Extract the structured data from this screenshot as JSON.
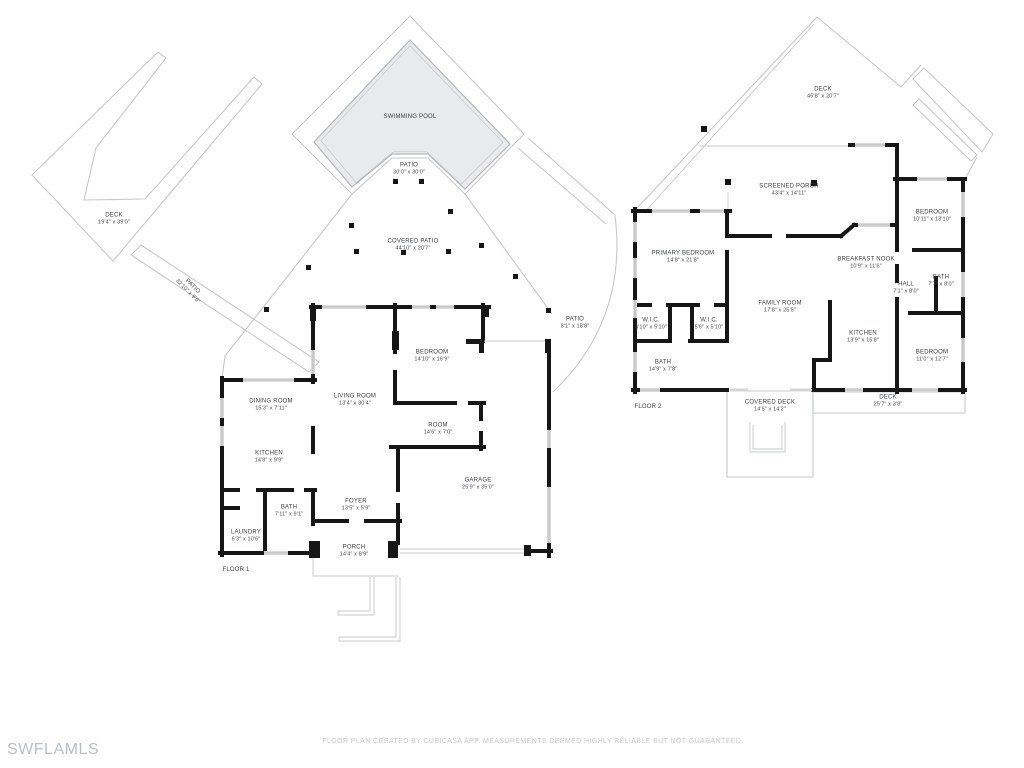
{
  "watermark": "SWFLAMLS",
  "footer": "FLOOR PLAN CREATED BY CUBICASA APP. MEASUREMENTS DEEMED HIGHLY RELIABLE BUT NOT GUARANTEED.",
  "colors": {
    "wall": "#161616",
    "outline": "#c6c9cb",
    "window": "#dadada",
    "pool_fill": "#e9eaeb",
    "label_text": "#3a3d40",
    "muted_text": "#c7c9cb"
  },
  "floors": [
    {
      "tag": "FLOOR 1",
      "tag_pos": {
        "x": 236,
        "y": 571
      },
      "rooms": [
        {
          "name": "DECK",
          "dims": "19'4\" x 39'0\"",
          "x": 114,
          "y": 219
        },
        {
          "name": "SWIMMING POOL",
          "dims": "",
          "x": 410,
          "y": 116
        },
        {
          "name": "PATIO",
          "dims": "30'0\" x 30'0\"",
          "x": 409,
          "y": 169
        },
        {
          "name": "COVERED PATIO",
          "dims": "44'10\" x 20'7\"",
          "x": 413,
          "y": 245
        },
        {
          "name": "PATIO",
          "dims": "32'10\" x 9'6\"",
          "x": 190,
          "y": 289,
          "rot": 45
        },
        {
          "name": "PATIO",
          "dims": "8'1\" x 18'8\"",
          "x": 575,
          "y": 323
        },
        {
          "name": "DINING ROOM",
          "dims": "15'3\" x 7'11\"",
          "x": 271,
          "y": 405
        },
        {
          "name": "LIVING ROOM",
          "dims": "13'4\" x 30'4\"",
          "x": 355,
          "y": 400
        },
        {
          "name": "KITCHEN",
          "dims": "14'8\" x 9'9\"",
          "x": 269,
          "y": 457
        },
        {
          "name": "BEDROOM",
          "dims": "14'10\" x 16'9\"",
          "x": 432,
          "y": 356
        },
        {
          "name": "ROOM",
          "dims": "14'6\" x 7'0\"",
          "x": 438,
          "y": 429
        },
        {
          "name": "GARAGE",
          "dims": "25'9\" x 35'0\"",
          "x": 478,
          "y": 484
        },
        {
          "name": "BATH",
          "dims": "7'11\" x 9'1\"",
          "x": 289,
          "y": 511
        },
        {
          "name": "FOYER",
          "dims": "13'5\" x 5'9\"",
          "x": 356,
          "y": 505
        },
        {
          "name": "LAUNDRY",
          "dims": "6'3\" x 10'6\"",
          "x": 246,
          "y": 536
        },
        {
          "name": "PORCH",
          "dims": "14'4\" x 8'9\"",
          "x": 354,
          "y": 551
        }
      ]
    },
    {
      "tag": "FLOOR 2",
      "tag_pos": {
        "x": 648,
        "y": 408
      },
      "rooms": [
        {
          "name": "DECK",
          "dims": "46'8\" x 20'7\"",
          "x": 823,
          "y": 93
        },
        {
          "name": "SCREENED PORCH",
          "dims": "43'4\" x 14'11\"",
          "x": 789,
          "y": 190
        },
        {
          "name": "PRIMARY BEDROOM",
          "dims": "14'8\" x 21'8\"",
          "x": 683,
          "y": 257
        },
        {
          "name": "W.I.C.",
          "dims": "4'10\" x 5'10\"",
          "x": 651,
          "y": 324
        },
        {
          "name": "W.I.C.",
          "dims": "5'6\" x 5'10\"",
          "x": 709,
          "y": 324
        },
        {
          "name": "BATH",
          "dims": "14'9\" x 7'8\"",
          "x": 663,
          "y": 366
        },
        {
          "name": "FAMILY ROOM",
          "dims": "17'8\" x 25'5\"",
          "x": 780,
          "y": 307
        },
        {
          "name": "BREAKFAST NOOK",
          "dims": "10'9\" x 11'6\"",
          "x": 866,
          "y": 263
        },
        {
          "name": "BEDROOM",
          "dims": "10'11\" x 13'10\"",
          "x": 932,
          "y": 216
        },
        {
          "name": "BATH",
          "dims": "7'7\" x 8'0\"",
          "x": 941,
          "y": 281
        },
        {
          "name": "HALL",
          "dims": "7'1\" x 8'0\"",
          "x": 906,
          "y": 288
        },
        {
          "name": "KITCHEN",
          "dims": "13'9\" x 15'8\"",
          "x": 863,
          "y": 337
        },
        {
          "name": "BEDROOM",
          "dims": "11'0\" x 12'7\"",
          "x": 932,
          "y": 356
        },
        {
          "name": "COVERED DECK",
          "dims": "14'5\" x 14'2\"",
          "x": 770,
          "y": 406
        },
        {
          "name": "DECK",
          "dims": "25'7\" x 3'8\"",
          "x": 888,
          "y": 401
        }
      ]
    }
  ]
}
